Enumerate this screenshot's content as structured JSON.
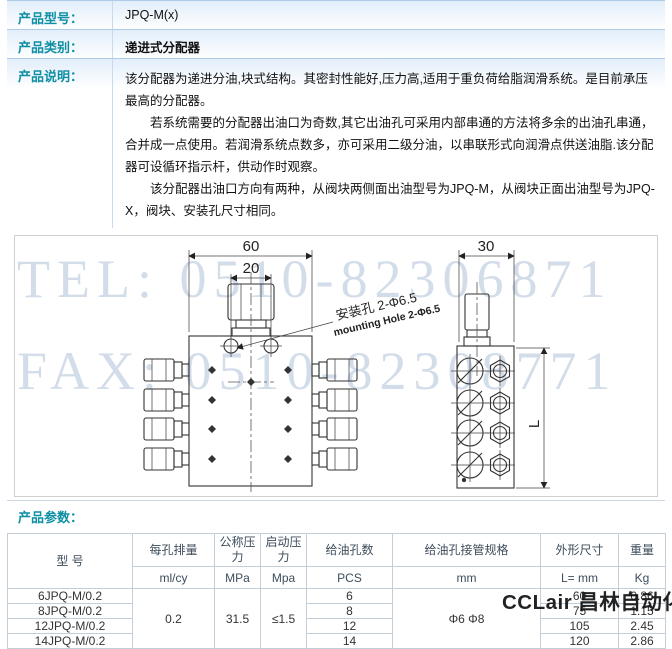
{
  "info": {
    "rows": [
      {
        "label": "产品型号：",
        "value": "JPQ-M(x)"
      },
      {
        "label": "产品类别：",
        "value": "递进式分配器"
      },
      {
        "label": "产品说明：",
        "paragraphs": [
          "该分配器为递进分油,块式结构。其密封性能好,压力高,适用于重负荷给脂润滑系统。是目前承压最高的分配器。",
          "若系统需要的分配器出油口为奇数,其它出油孔可采用内部串通的方法将多余的出油孔串通，合并成一点使用。若润滑系统点数多，亦可采用二级分油，以串联形式向润滑点供送油脂.该分配器可设循环指示杆，供动作时观察。",
          "该分配器出油口方向有两种，从阀块两侧面出油型号为JPQ-M，从阀块正面出油型号为JPQ-X，阀块、安装孔尺寸相同。"
        ]
      }
    ]
  },
  "drawing": {
    "watermark_tel": "TEL: 0510-82306871",
    "watermark_fax": "FAX: 0510-82308771",
    "dim_top_width": "60",
    "dim_hole_spacing": "20",
    "dim_side_width": "30",
    "dim_height": "L",
    "annotation_cn": "安装孔 2-Φ6.5",
    "annotation_en": "mounting Hole 2-Φ6.5"
  },
  "params": {
    "title": "产品参数：",
    "table": {
      "col_model": "型  号",
      "headers": [
        "每孔排量",
        "公称压力",
        "启动压力",
        "给油孔数",
        "给油孔接管规格",
        "外形尺寸",
        "重量"
      ],
      "units": [
        "ml/cy",
        "MPa",
        "Mpa",
        "PCS",
        "mm",
        "L= mm",
        "Kg"
      ],
      "merged": {
        "displacement": "0.2",
        "nominal_pressure": "31.5",
        "start_pressure": "≤1.5",
        "pipe_spec": "Φ6 Φ8"
      },
      "rows": [
        {
          "model": "6JPQ-M/0.2",
          "holes": "6",
          "length": "60",
          "weight": "0.86"
        },
        {
          "model": "8JPQ-M/0.2",
          "holes": "8",
          "length": "75",
          "weight": "1.15"
        },
        {
          "model": "12JPQ-M/0.2",
          "holes": "12",
          "length": "105",
          "weight": "2.45"
        },
        {
          "model": "14JPQ-M/0.2",
          "holes": "14",
          "length": "120",
          "weight": "2.86"
        }
      ]
    }
  },
  "brand_watermark": "CCLair 昌林自动化"
}
